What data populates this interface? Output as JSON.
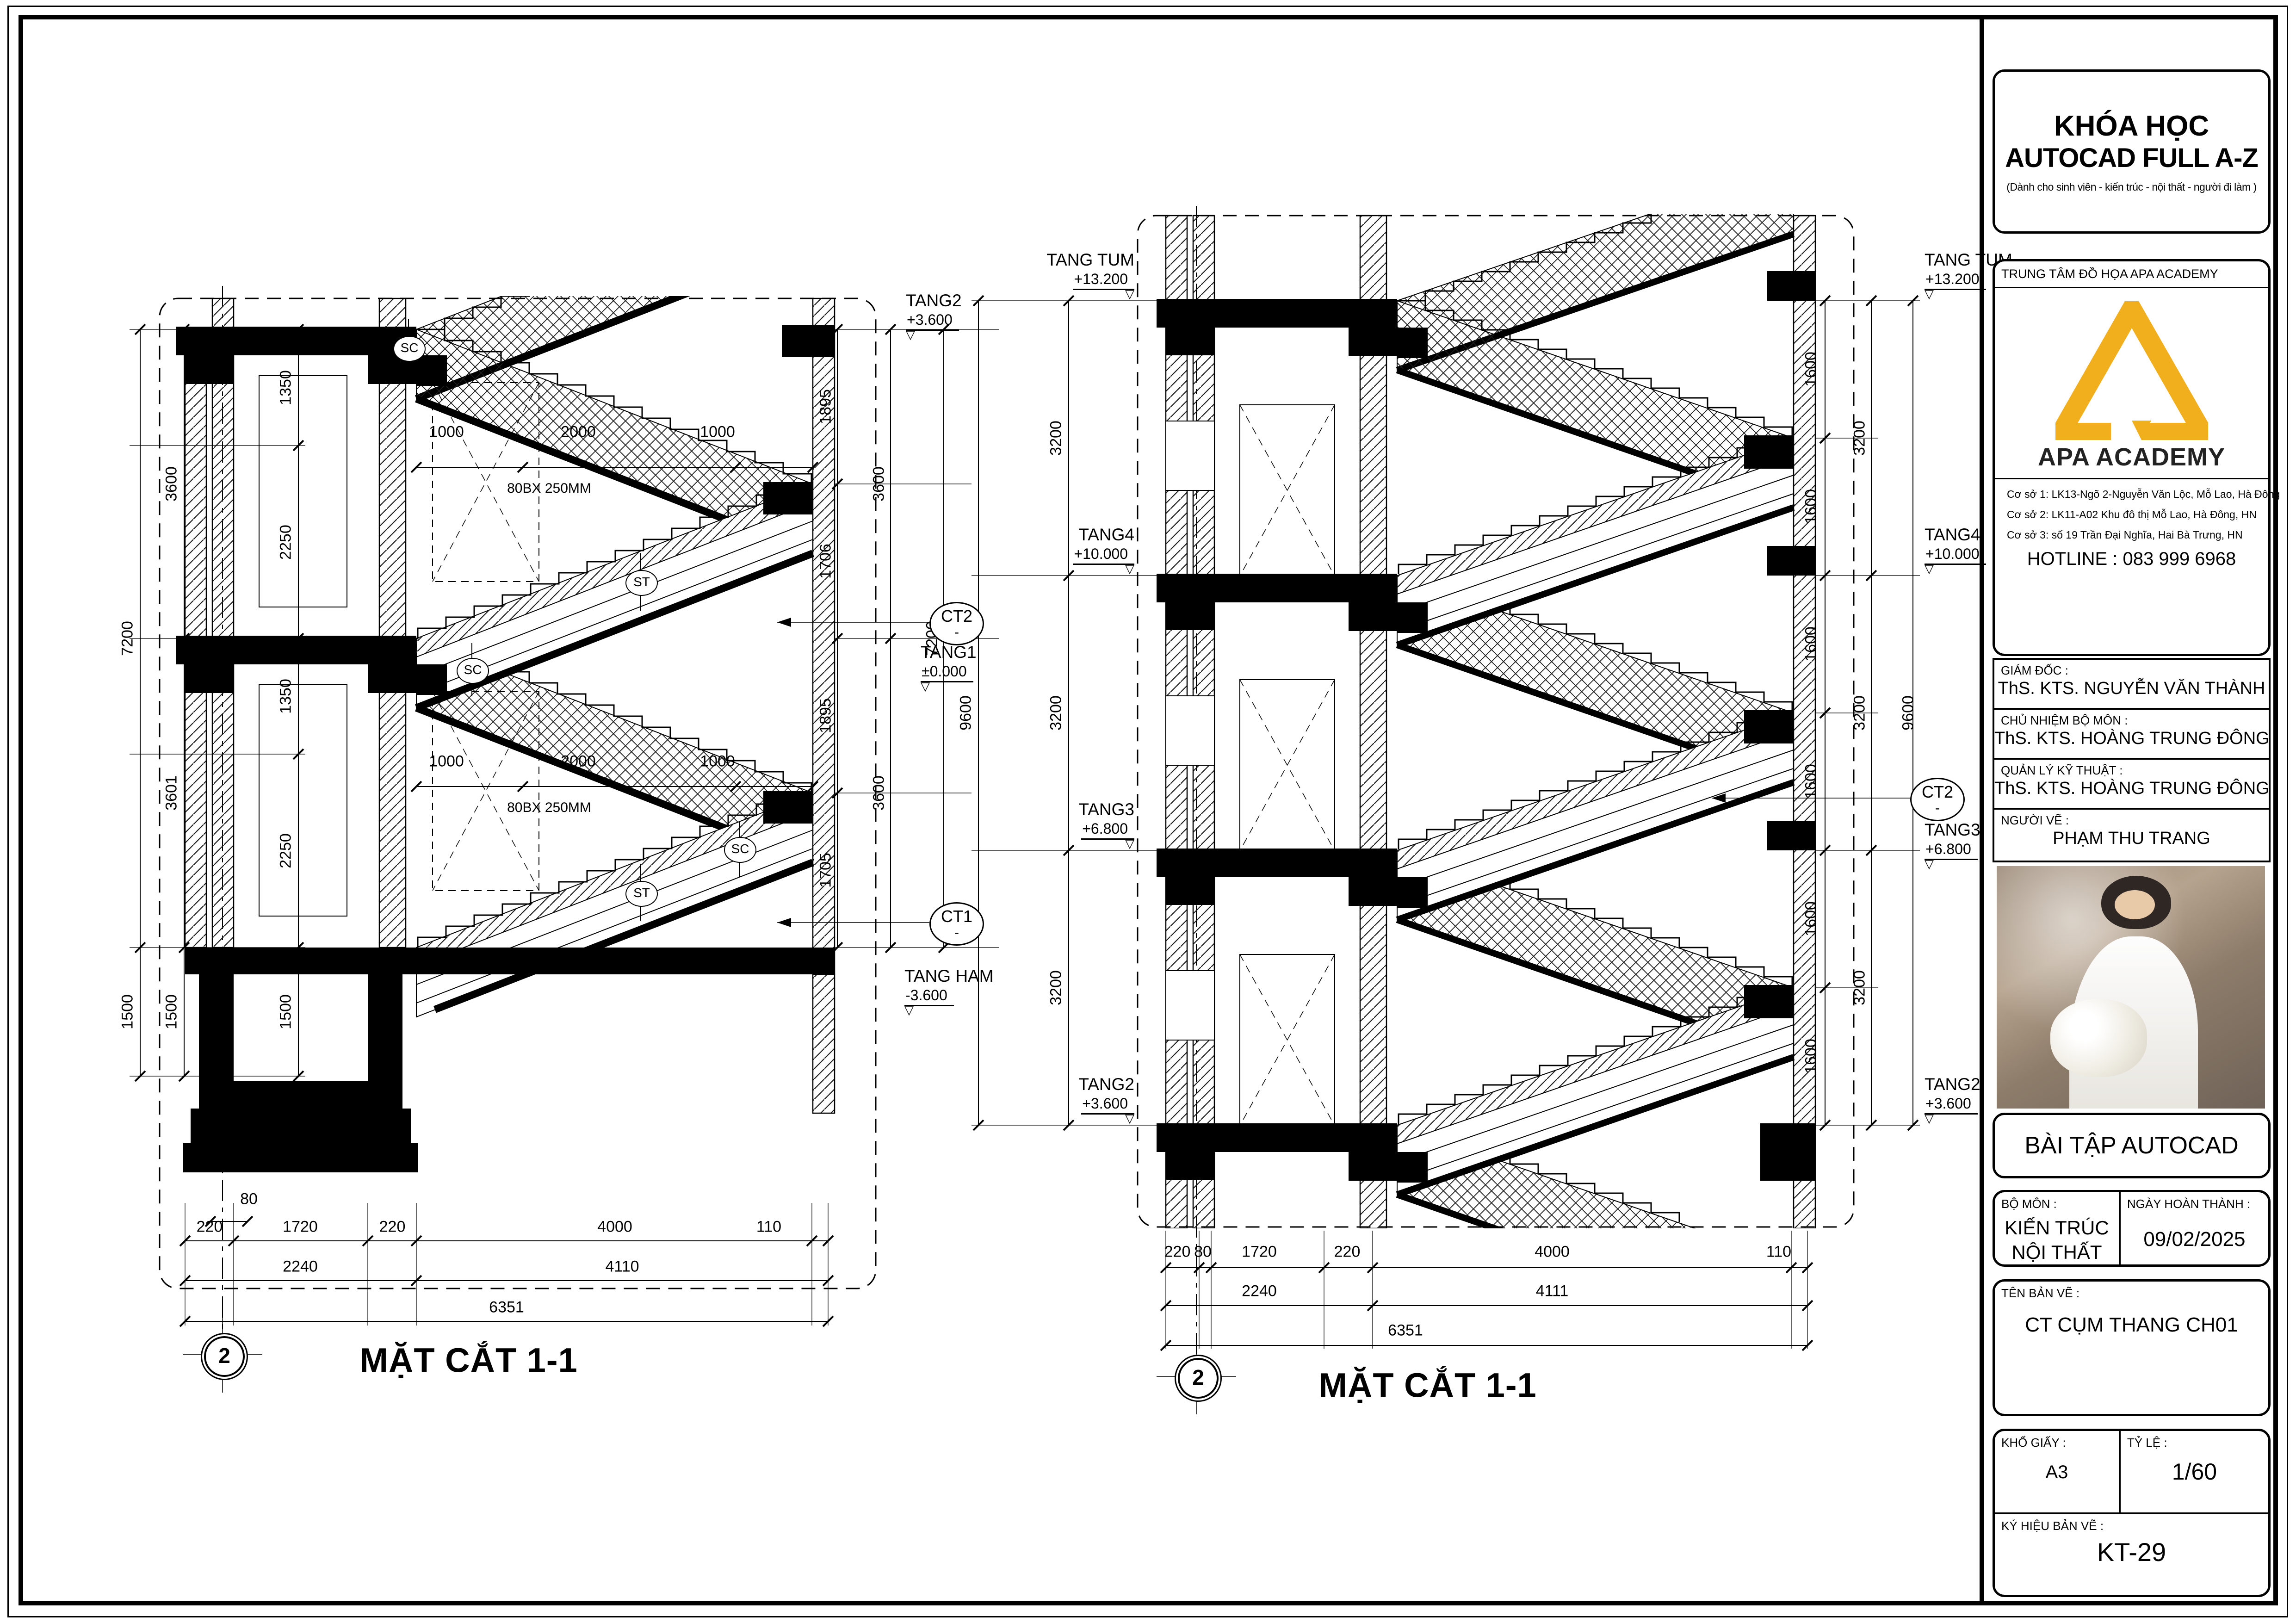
{
  "title_block": {
    "course_line1": "KHÓA HỌC",
    "course_line2": "AUTOCAD FULL A-Z",
    "course_subtitle": "(Dành cho sinh viên - kiến trúc - nội thất - người đi làm )",
    "center_label": "TRUNG TÂM ĐỒ HỌA APA ACADEMY",
    "logo_text": "APA ACADEMY",
    "logo_color": "#F2AF1D",
    "addresses": [
      "Cơ sở 1: LK13-Ngõ 2-Nguyễn Văn Lộc, Mỗ Lao, Hà Đông",
      "Cơ sở 2: LK11-A02 Khu đô thị Mỗ Lao, Hà Đông, HN",
      "Cơ sở 3: số 19 Trần Đại Nghĩa, Hai Bà Trưng, HN"
    ],
    "hotline": "HOTLINE : 083 999 6968",
    "rows": [
      {
        "label": "GIÁM ĐỐC :",
        "value": "ThS. KTS. NGUYỄN VĂN THÀNH"
      },
      {
        "label": "CHỦ NHIỆM BỘ MÔN :",
        "value": "ThS. KTS. HOÀNG TRUNG ĐÔNG"
      },
      {
        "label": "QUẢN LÝ KỸ THUẬT :",
        "value": "ThS. KTS. HOÀNG TRUNG ĐÔNG"
      },
      {
        "label": "NGƯỜI VẼ :",
        "value": "PHẠM THU TRANG"
      }
    ],
    "exercise_label": "BÀI TẬP AUTOCAD",
    "bo_mon_label": "BỘ MÔN :",
    "bo_mon_line1": "KIẾN TRÚC",
    "bo_mon_line2": "NỘI THẤT",
    "date_label": "NGÀY HOÀN THÀNH :",
    "date_value": "09/02/2025",
    "drawing_name_label": "TÊN BẢN VẼ :",
    "drawing_name": "CT CỤM THANG CH01",
    "paper_label": "KHỔ GIẤY :",
    "paper_value": "A3",
    "scale_label": "TỶ LỆ :",
    "scale_value": "1/60",
    "code_label": "KÝ HIỆU BẢN VẼ :",
    "code_value": "KT-29"
  },
  "left_drawing": {
    "title": "MẶT CẮT 1-1",
    "bubble": "2",
    "sc_label": "SC",
    "st_label": "ST",
    "note": "80BX 250MM",
    "levels": [
      {
        "name": "TANG2",
        "elev": "+3.600"
      },
      {
        "name": "TANG1",
        "elev": "±0.000"
      },
      {
        "name": "TANG HAM",
        "elev": "-3.600"
      }
    ],
    "ct": [
      {
        "id": "CT2",
        "sub": "-"
      },
      {
        "id": "CT1",
        "sub": "-"
      }
    ],
    "dims": {
      "v_inner_left": [
        "1350",
        "2250",
        "1350",
        "2250",
        "1500"
      ],
      "v_mid_left": [
        "3600",
        "3601",
        "1500"
      ],
      "v_outer_left": [
        "7200",
        "1500"
      ],
      "v_inner_right": [
        "1895",
        "1706",
        "1895",
        "1705"
      ],
      "v_mid_right": [
        "3600",
        "3600"
      ],
      "v_outer_right": [
        "7200"
      ],
      "run_top": [
        "1000",
        "2000",
        "1000"
      ],
      "run_mid": [
        "1000",
        "2000",
        "1000"
      ],
      "b80": "80",
      "row1": [
        "220",
        "1720",
        "220",
        "4000",
        "110"
      ],
      "row2": [
        "2240",
        "4110"
      ],
      "row3": "6351"
    }
  },
  "right_drawing": {
    "title": "MẶT CẮT 1-1",
    "bubble": "2",
    "levels_left": [
      {
        "name": "TANG TUM",
        "elev": "+13.200"
      },
      {
        "name": "TANG4",
        "elev": "+10.000"
      },
      {
        "name": "TANG3",
        "elev": "+6.800"
      },
      {
        "name": "TANG2",
        "elev": "+3.600"
      }
    ],
    "levels_right": [
      {
        "name": "TANG TUM",
        "elev": "+13.200"
      },
      {
        "name": "TANG4",
        "elev": "+10.000"
      },
      {
        "name": "TANG3",
        "elev": "+6.800"
      },
      {
        "name": "TANG2",
        "elev": "+3.600"
      }
    ],
    "ct": {
      "id": "CT2",
      "sub": "-"
    },
    "dims": {
      "v_left_3200": [
        "3200",
        "3200",
        "3200"
      ],
      "v_left_9600": "9600",
      "v_right_1600": [
        "1600",
        "1600",
        "1600",
        "1600",
        "1600",
        "1600"
      ],
      "v_right_3200": [
        "3200",
        "3200",
        "3200"
      ],
      "v_right_9600": "9600",
      "row1": [
        "220",
        "80",
        "1720",
        "220",
        "4000",
        "110"
      ],
      "row2": [
        "2240",
        "4111"
      ],
      "row3": "6351"
    }
  }
}
